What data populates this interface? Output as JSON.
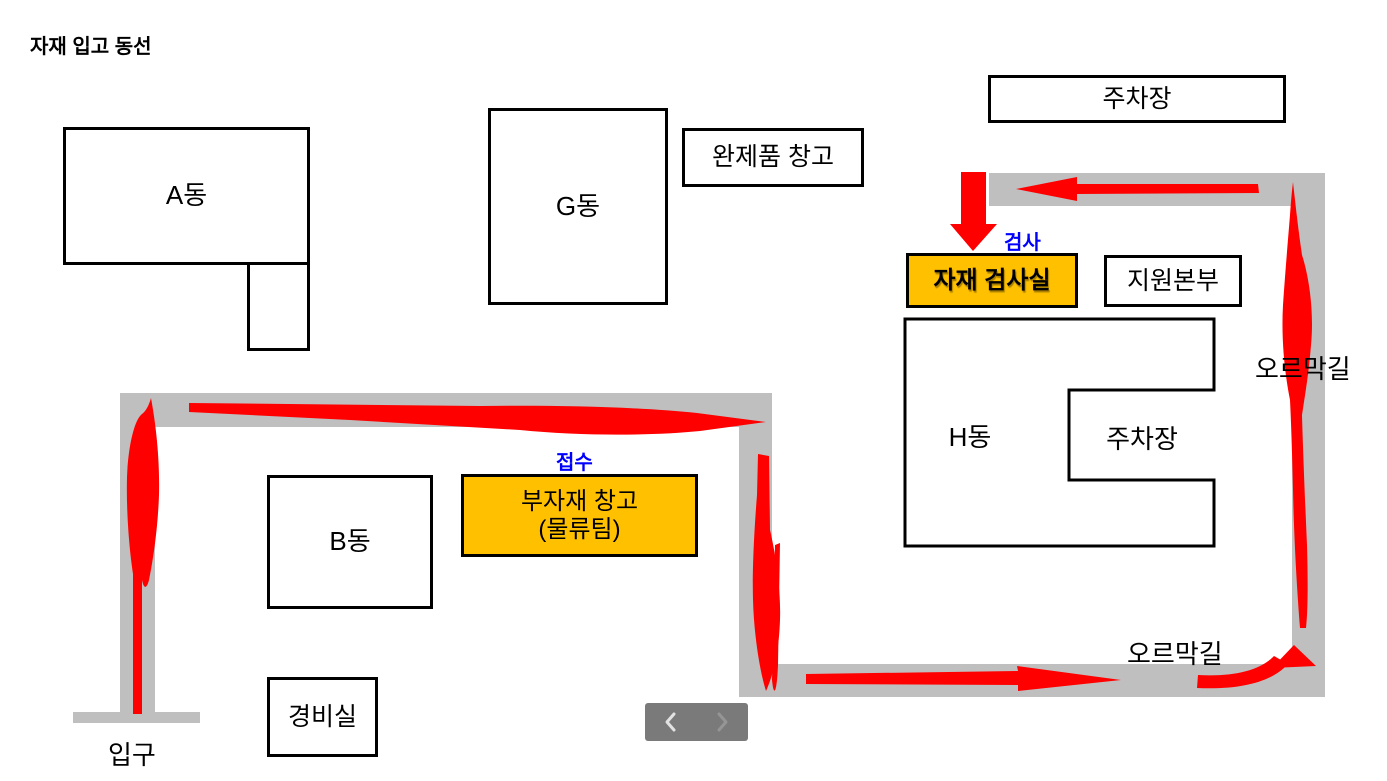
{
  "title": "자재 입고 동선",
  "colors": {
    "road": "#BFBFBF",
    "route_arrow": "#FF0000",
    "highlight_fill": "#FFC000",
    "annotation_blue": "#0000FF",
    "outline": "#000000"
  },
  "buildings": {
    "a_block": {
      "label": "A동"
    },
    "g_block": {
      "label": "G동"
    },
    "b_block": {
      "label": "B동"
    },
    "h_block": {
      "label": "H동"
    },
    "finished_goods_warehouse": {
      "label": "완제품 창고"
    },
    "parking_top": {
      "label": "주차장"
    },
    "parking_inner": {
      "label": "주차장"
    },
    "material_inspection_room": {
      "label": "자재 검사실"
    },
    "support_headquarters": {
      "label": "지원본부"
    },
    "submaterial_warehouse": {
      "label": "부자재 창고",
      "sublabel": "(물류팀)"
    },
    "security_office": {
      "label": "경비실"
    }
  },
  "annotations": {
    "inspection": "검사",
    "reception": "접수",
    "uphill_road_right": "오르막길",
    "uphill_road_bottom": "오르막길",
    "entrance": "입구"
  }
}
